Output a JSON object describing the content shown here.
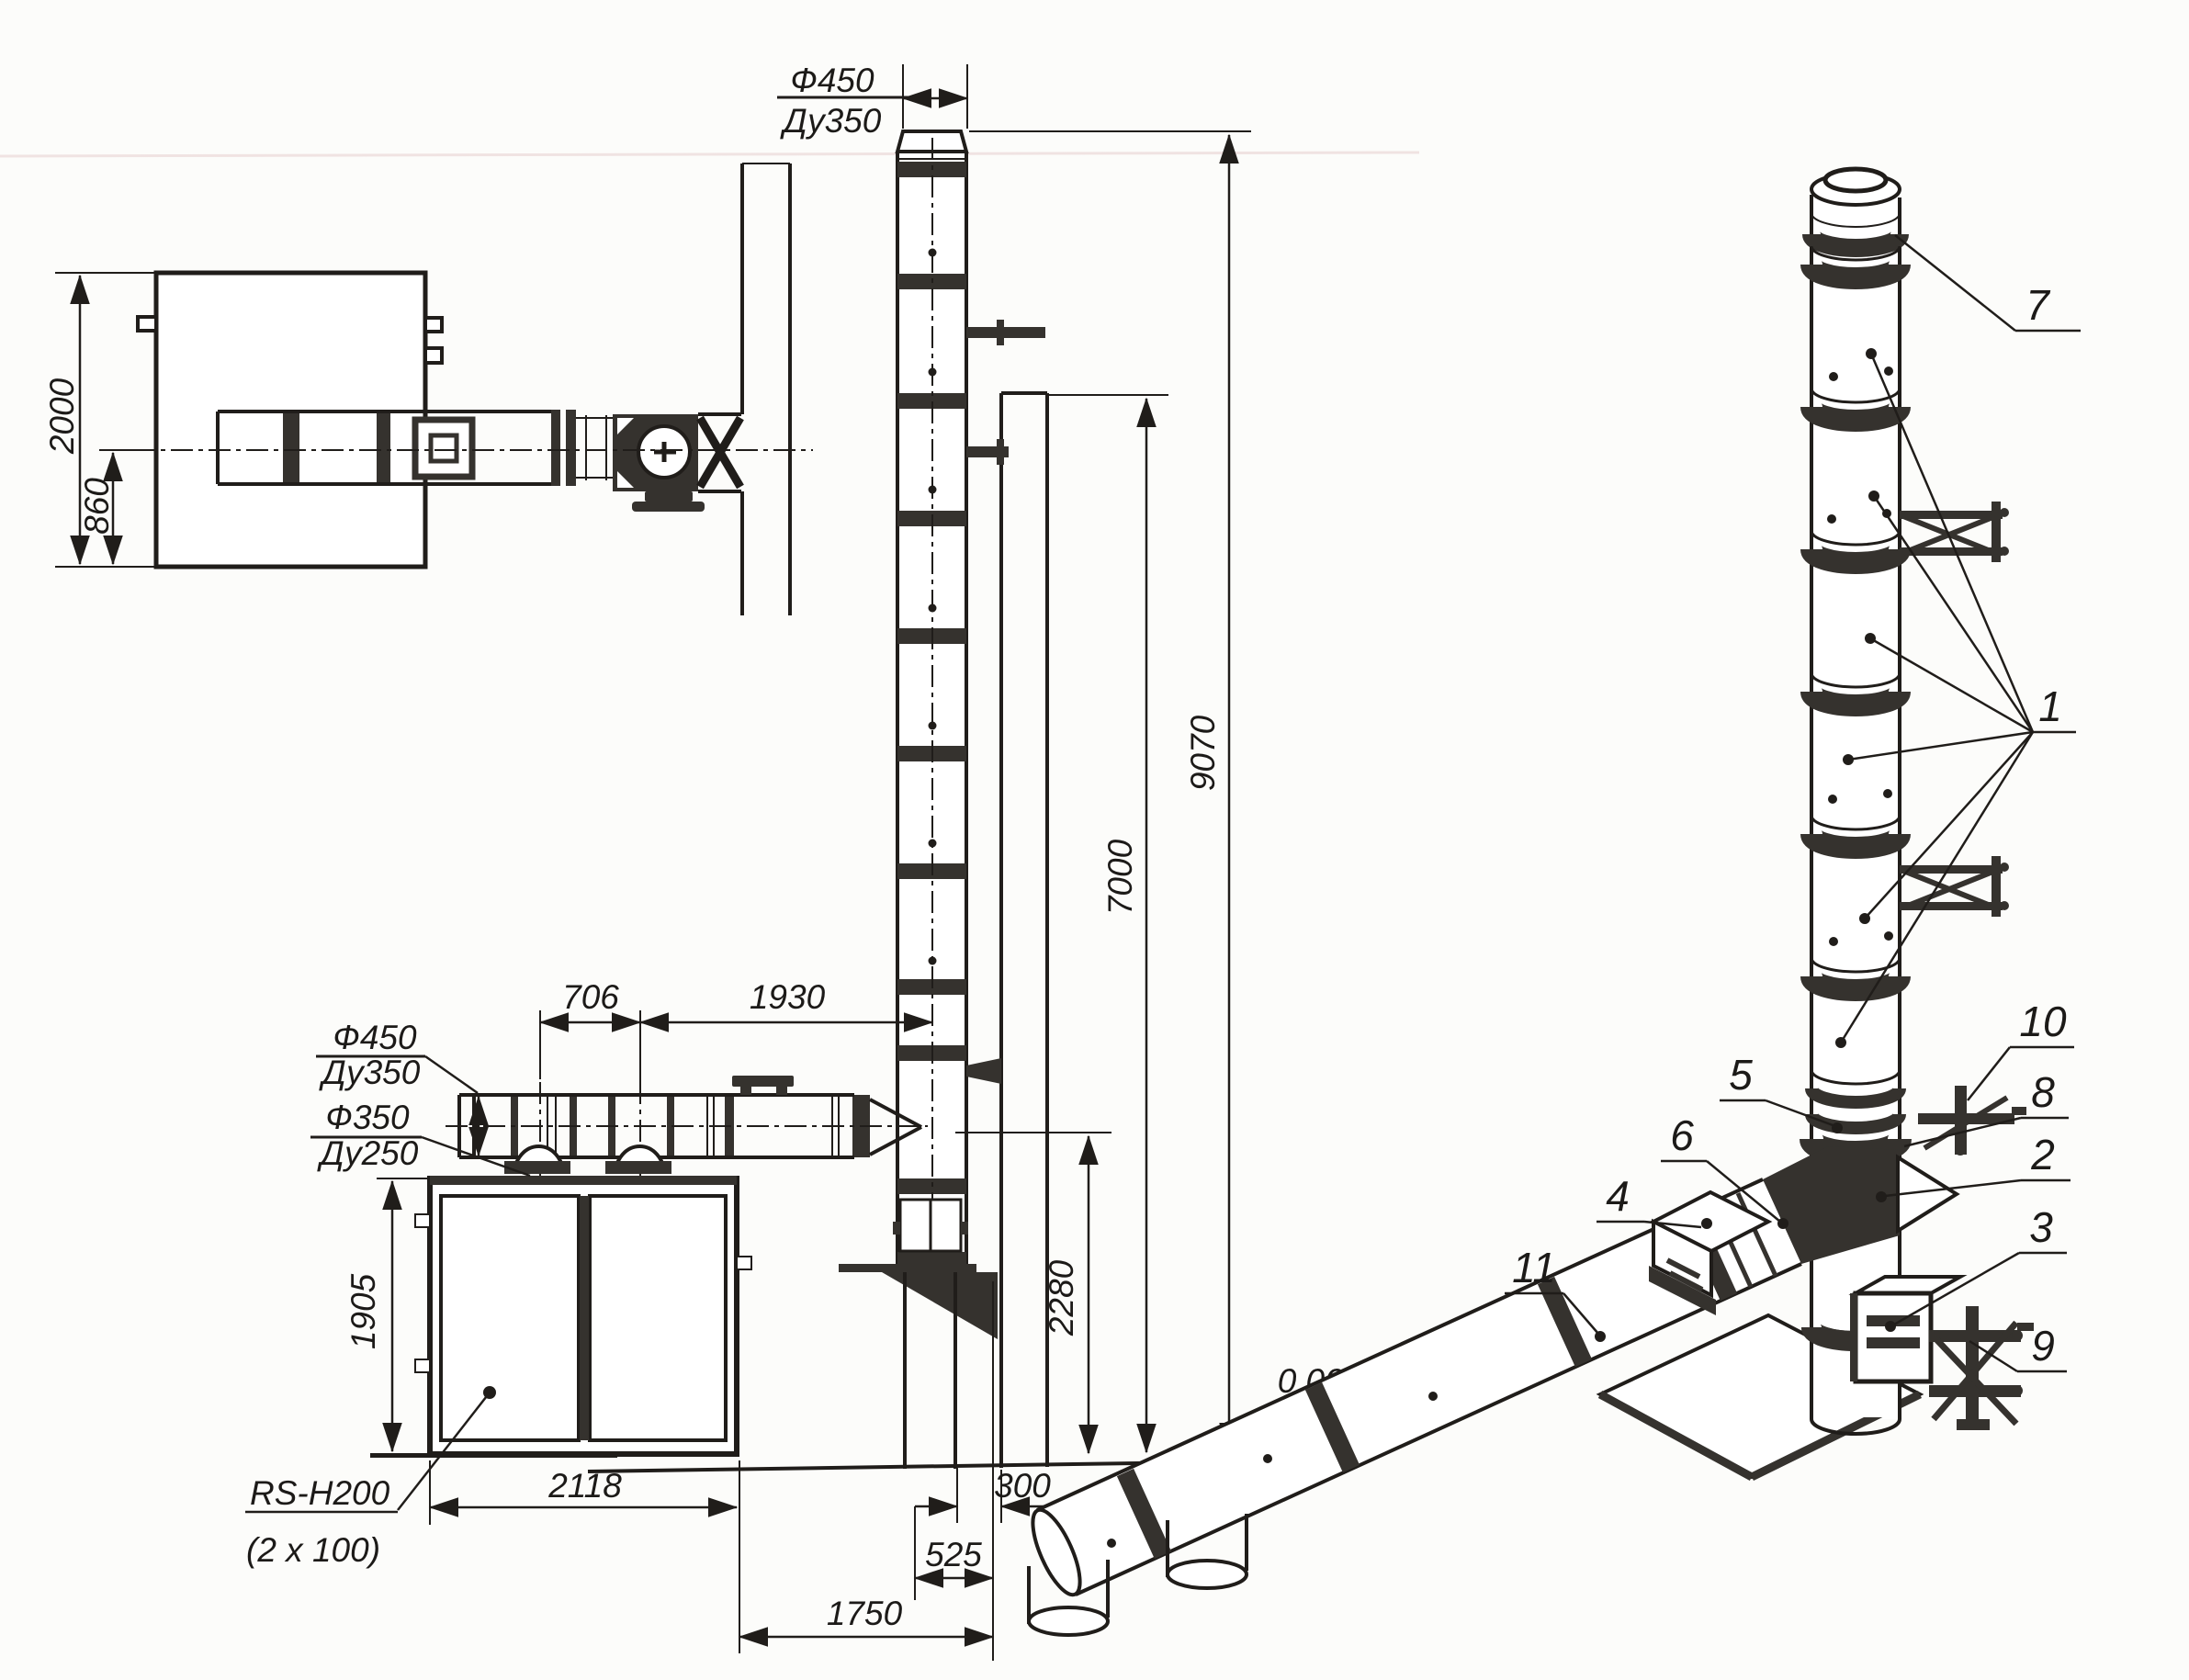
{
  "plan": {
    "depth": "2000",
    "axis_offset": "860"
  },
  "stack_top": {
    "dia": "Ф450",
    "dn": "Ду350"
  },
  "duct": {
    "outer_dia": "Ф450",
    "outer_dn": "Ду350",
    "inner_dia": "Ф350",
    "inner_dn": "Ду250"
  },
  "dims": {
    "outlet_spacing": "706",
    "duct_run": "1930",
    "total_height": "9070",
    "wall_height": "7000",
    "duct_axis_height": "2280",
    "boiler_height": "1905",
    "boiler_width": "2118",
    "wall_gap": "300",
    "base_offset": "525",
    "boiler_to_wall": "1750"
  },
  "level": {
    "zero": "0,000"
  },
  "boiler": {
    "model": "RS-H200",
    "qty": "(2 x 100)"
  },
  "parts": {
    "n1": "1",
    "n2": "2",
    "n3": "3",
    "n4": "4",
    "n5": "5",
    "n6": "6",
    "n7": "7",
    "n8": "8",
    "n9": "9",
    "n10": "10",
    "n11": "11"
  }
}
